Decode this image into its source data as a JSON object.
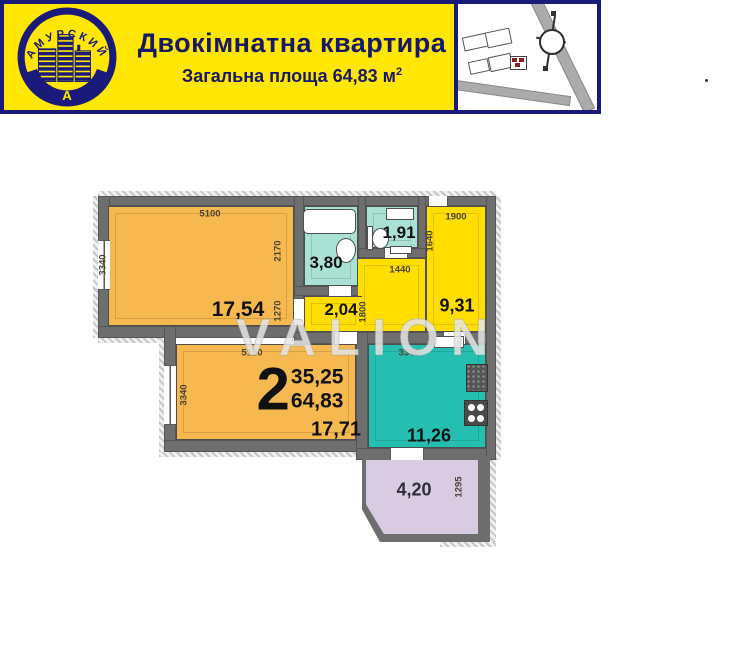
{
  "header": {
    "title": "Двокімнатна квартира",
    "subtitle": "Загальна площа 64,83 м",
    "subtitle_sup": "2",
    "logo": {
      "arc_text": "АМУРСКИЙ",
      "bottom_text": "А"
    }
  },
  "plan": {
    "watermark": "VALION",
    "summary": {
      "room_count": "2",
      "living_area": "35,25",
      "total_area": "64,83"
    },
    "room1": {
      "area": "17,54",
      "dim_top": "5100",
      "dim_left": "3340",
      "dim_right_upper": "2170",
      "dim_right_lower": "1270"
    },
    "bathroom": {
      "area": "3,80"
    },
    "wc": {
      "area": "1,91",
      "dim_bottom": "1440",
      "dim_right": "1640"
    },
    "hallway": {
      "area": "2,04",
      "dim_right": "1800"
    },
    "entry_hall": {
      "area": "9,31",
      "dim_top": "1900"
    },
    "room2": {
      "area": "17,71",
      "dim_top": "5150",
      "dim_left": "3340"
    },
    "kitchen": {
      "area": "11,26",
      "dim_top": "3340"
    },
    "balcony": {
      "area": "4,20",
      "dim_right": "1295"
    }
  },
  "colors": {
    "banner_yellow": "#FFE603",
    "navy": "#1A1A7A",
    "room_orange": "#F5B94F",
    "hall_yellow": "#FFDE00",
    "bath_teal": "#A9E2D4",
    "kitchen_teal": "#25BFB1",
    "balcony_lavender": "#D8CCE2",
    "wall_gray": "#6E6E6E"
  }
}
